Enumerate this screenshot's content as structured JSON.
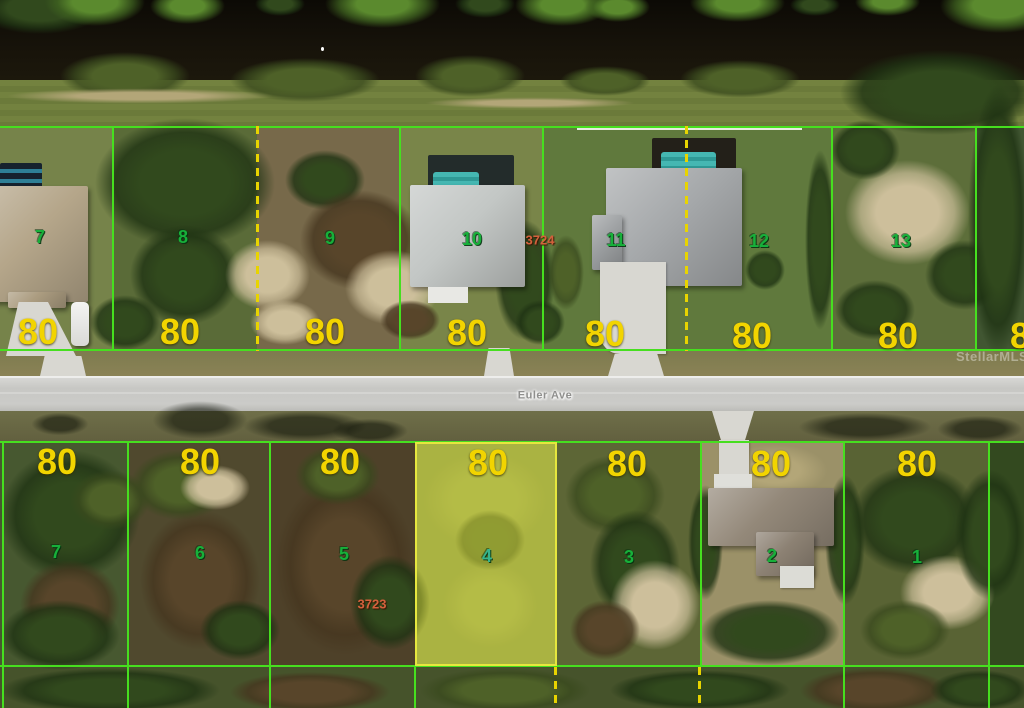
{
  "street": {
    "name": "Euler Ave"
  },
  "watermark": "StellarMLS",
  "upper_row": {
    "parcel_id": "3724",
    "edge_frontage": "80",
    "lots": [
      {
        "number": "7",
        "frontage": "80"
      },
      {
        "number": "8",
        "frontage": "80"
      },
      {
        "number": "9",
        "frontage": "80"
      },
      {
        "number": "10",
        "frontage": "80"
      },
      {
        "number": "11",
        "frontage": "80"
      },
      {
        "number": "12",
        "frontage": "80"
      },
      {
        "number": "13",
        "frontage": "80"
      }
    ]
  },
  "lower_row": {
    "parcel_id": "3723",
    "lots": [
      {
        "number": "7",
        "frontage": "80"
      },
      {
        "number": "6",
        "frontage": "80"
      },
      {
        "number": "5",
        "frontage": "80"
      },
      {
        "number": "4",
        "frontage": "80",
        "highlighted": true
      },
      {
        "number": "3",
        "frontage": "80"
      },
      {
        "number": "2",
        "frontage": "80"
      },
      {
        "number": "1",
        "frontage": "80"
      }
    ]
  },
  "colors": {
    "lot_line_green": "#46df1f",
    "dashed_line_yellow": "#e8d400",
    "highlight_yellow": "#e6e73e",
    "frontage_text": "#f2d400",
    "lot_number_text": "#17b03a",
    "parcel_id_text": "#d4603c"
  }
}
